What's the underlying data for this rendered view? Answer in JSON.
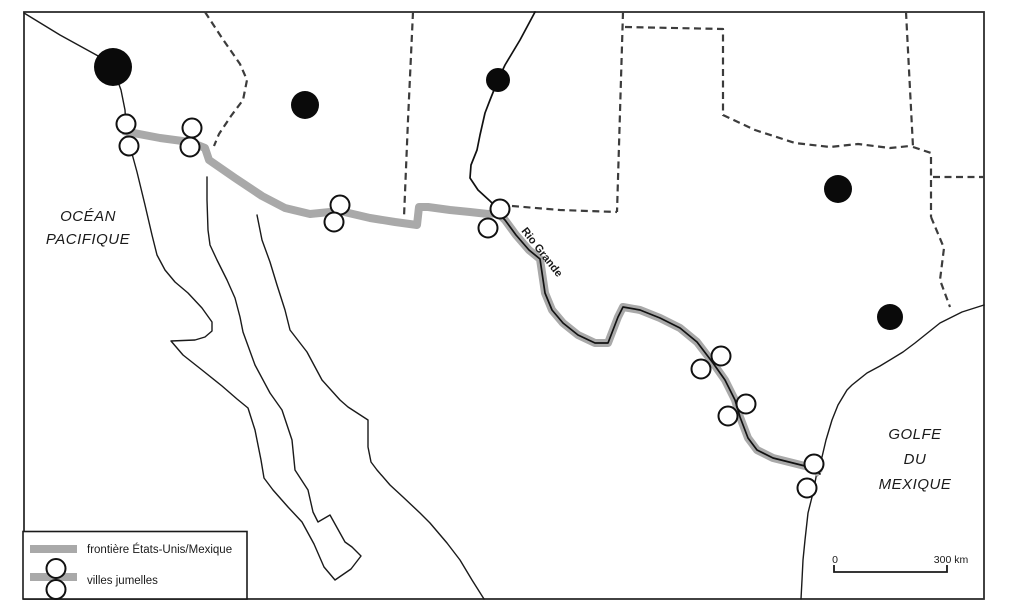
{
  "map": {
    "labels": {
      "ocean_line1": "OCÉAN",
      "ocean_line2": "PACIFIQUE",
      "gulf_line1": "GOLFE",
      "gulf_line2": "DU",
      "gulf_line3": "MEXIQUE",
      "river": "Rio Grande"
    },
    "legend": {
      "items": [
        {
          "symbol": "border-line-swatch",
          "label": "frontière États-Unis/Mexique"
        },
        {
          "symbol": "twin-cities-swatch",
          "label": "villes jumelles"
        }
      ]
    },
    "scale_bar": {
      "start_label": "0",
      "end_label": "300 km"
    },
    "colors": {
      "border_line_gray": "#a9a9a9",
      "coastline": "#1a1a1a",
      "state_border_dash": "#3c3c3c",
      "city_dot": "#0a0a0a",
      "twin_circle_fill": "#ffffff"
    },
    "markers": {
      "major_cities": [
        {
          "x": 113,
          "y": 67,
          "r": 19
        },
        {
          "x": 305,
          "y": 105,
          "r": 14
        },
        {
          "x": 498,
          "y": 80,
          "r": 12
        },
        {
          "x": 838,
          "y": 189,
          "r": 14
        },
        {
          "x": 890,
          "y": 317,
          "r": 13
        }
      ],
      "twin_city_pairs": [
        {
          "a": {
            "x": 126,
            "y": 124
          },
          "b": {
            "x": 129,
            "y": 146
          }
        },
        {
          "a": {
            "x": 192,
            "y": 128
          },
          "b": {
            "x": 190,
            "y": 147
          }
        },
        {
          "a": {
            "x": 340,
            "y": 205
          },
          "b": {
            "x": 334,
            "y": 222
          }
        },
        {
          "a": {
            "x": 500,
            "y": 209
          },
          "b": {
            "x": 488,
            "y": 228
          }
        },
        {
          "a": {
            "x": 721,
            "y": 356
          },
          "b": {
            "x": 701,
            "y": 369
          }
        },
        {
          "a": {
            "x": 746,
            "y": 404
          },
          "b": {
            "x": 728,
            "y": 416
          }
        },
        {
          "a": {
            "x": 814,
            "y": 464
          },
          "b": {
            "x": 807,
            "y": 488
          }
        }
      ]
    }
  }
}
